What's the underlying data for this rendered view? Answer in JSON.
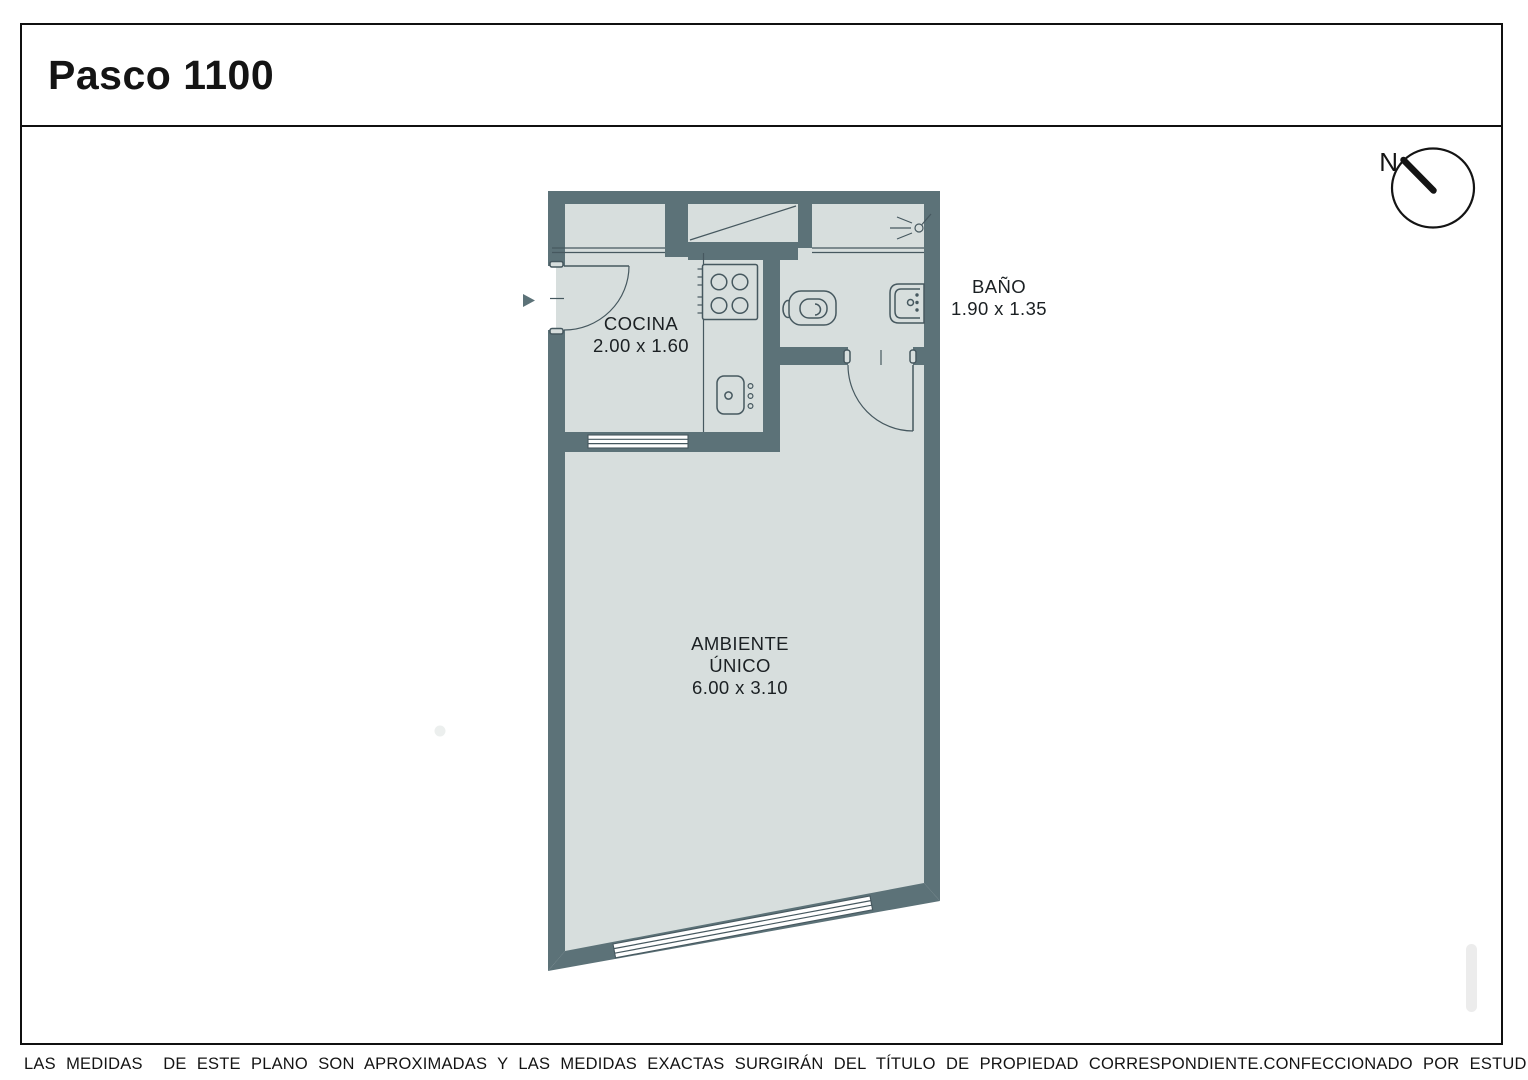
{
  "title": "Pasco 1100",
  "compass": {
    "north": "N"
  },
  "rooms": {
    "cocina": {
      "label": "COCINA",
      "dims": "2.00 x 1.60"
    },
    "bano": {
      "label": "BAÑO",
      "dims": "1.90 x 1.35"
    },
    "ambiente": {
      "line1": "AMBIENTE",
      "line2": "ÚNICO",
      "dims": "6.00 x 3.10"
    }
  },
  "footer": {
    "disclaimer": "LAS MEDIDAS  DE ESTE PLANO SON APROXIMADAS Y LAS MEDIDAS EXACTAS SURGIRÁN DEL TÍTULO DE PROPIEDAD CORRESPONDIENTE.",
    "credit": "CONFECCIONADO POR ESTUDIO NARTEX"
  },
  "icons": {
    "compass": "north-compass",
    "stove": "four-burner-stove",
    "kitchen_sink": "kitchen-sink",
    "toilet": "toilet",
    "bath_sink": "bathroom-sink",
    "light": "light-fixture",
    "entrance_arrow": "entrance-arrow",
    "closet": "closet-diagonal"
  },
  "colors": {
    "wall": "#5c7278",
    "floor": "#d7dedd",
    "line": "#46585f",
    "ink": "#141414",
    "white": "#ffffff",
    "scrollbar": "#ececec",
    "dot": "#ecefee"
  }
}
